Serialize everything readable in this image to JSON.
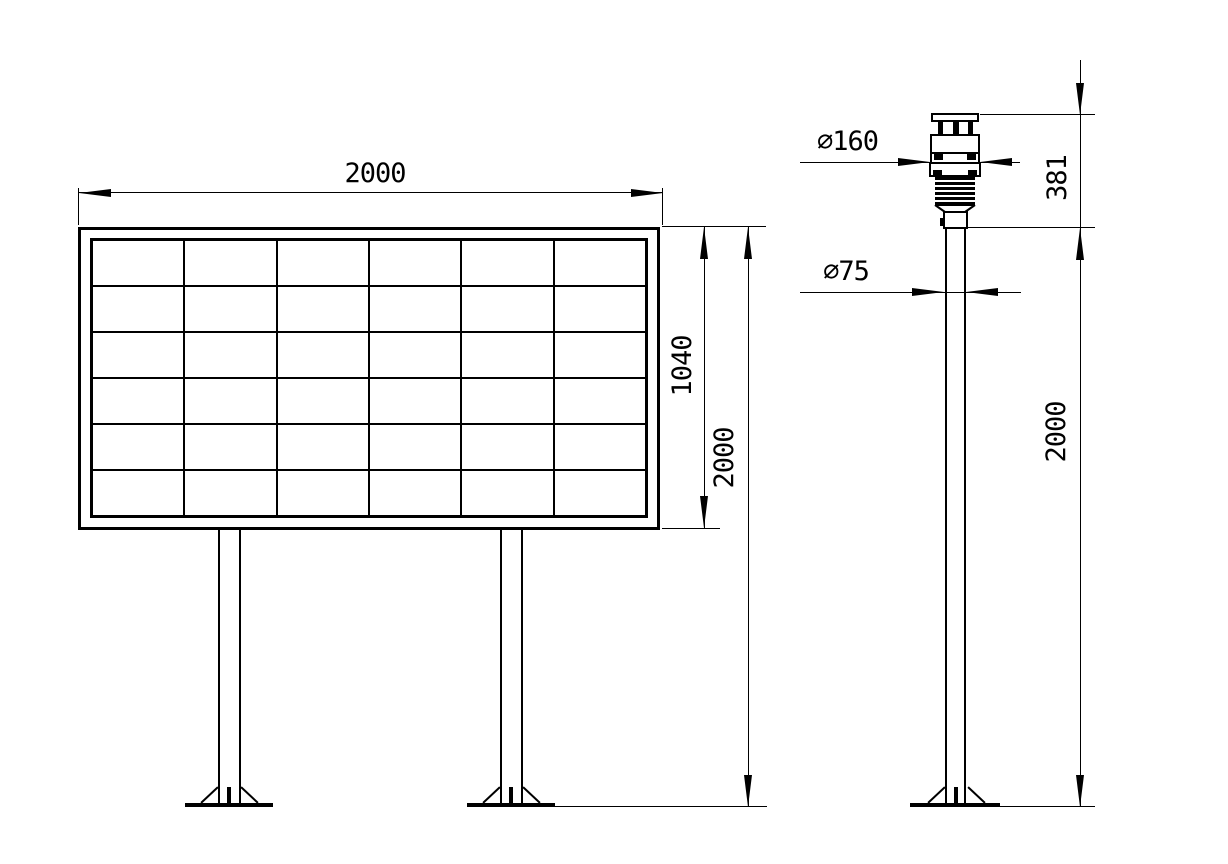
{
  "colors": {
    "line": "#000000",
    "background": "#ffffff"
  },
  "front_view": {
    "panel_grid": {
      "rows": 6,
      "cols": 6
    },
    "dimensions": {
      "board_width": "2000",
      "panel_height": "1040",
      "overall_height": "2000"
    }
  },
  "side_view": {
    "dimensions": {
      "sensor_diameter": "∅160",
      "pole_diameter": "∅75",
      "sensor_height": "381",
      "pole_height": "2000"
    }
  }
}
